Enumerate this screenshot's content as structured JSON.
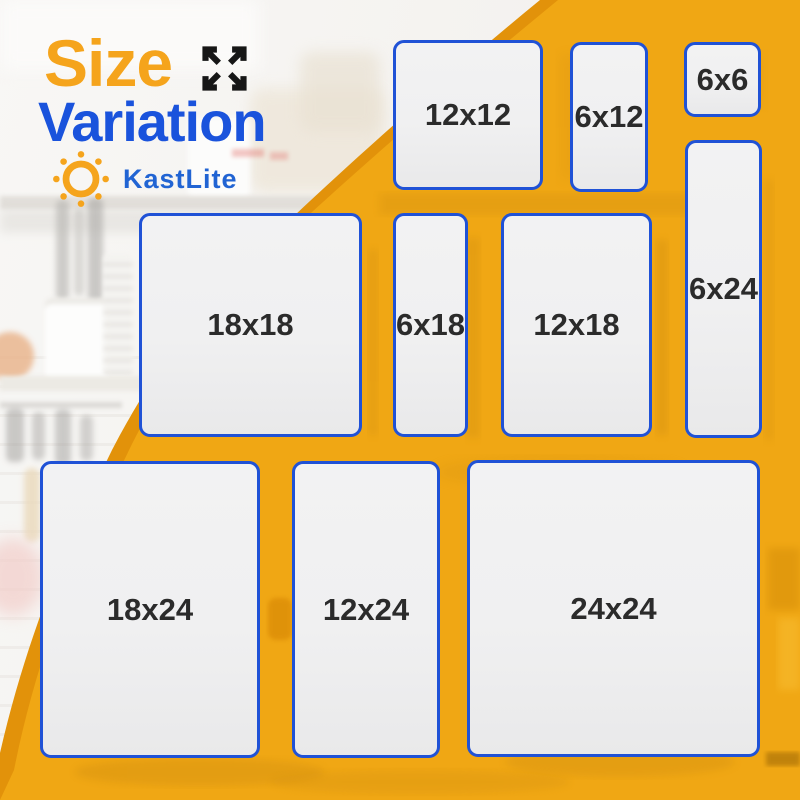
{
  "header": {
    "title_line1": "Size",
    "title_line2": "Variation"
  },
  "brand": {
    "name": "KastLite"
  },
  "icons": {
    "expand": "expand-arrows-icon",
    "logo": "sun-icon"
  },
  "size_boxes": [
    {
      "label": "12x12"
    },
    {
      "label": "6x12"
    },
    {
      "label": "6x6"
    },
    {
      "label": "6x24"
    },
    {
      "label": "18x18"
    },
    {
      "label": "6x18"
    },
    {
      "label": "12x18"
    },
    {
      "label": "18x24"
    },
    {
      "label": "12x24"
    },
    {
      "label": "24x24"
    }
  ],
  "colors": {
    "title-orange": "#F5A41C",
    "title-blue": "#1A53DC",
    "brand-blue": "#2164D3",
    "box-border": "#2052D6",
    "box-fill": "#F0F0F1",
    "box-text": "#2B2B2B",
    "bg-yellow": "#F0A714",
    "bg-orange-accent": "#E2920A",
    "icon-black": "#161616"
  }
}
